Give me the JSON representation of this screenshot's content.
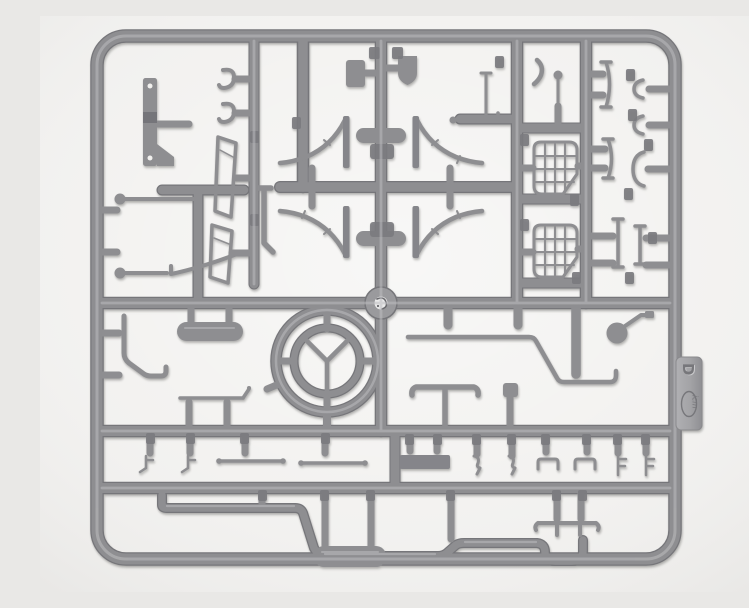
{
  "image": {
    "subject": "gray injection-molded plastic model kit sprue (parts runner) photographed on a light neutral background",
    "sprue_letter": "D",
    "brand": "ICM"
  },
  "colors": {
    "background": "#f1f0ee",
    "plastic": "#8e8e91",
    "plastic_dark": "#76767a",
    "plastic_light": "#bdbdc0",
    "gate_pad": "#7b7b7f",
    "tab_fill": "#a3a3a6",
    "emboss_dark": "#77777b",
    "emboss_light": "#c9c9cb"
  },
  "tab": {
    "letter": "D",
    "logo_text": "icm"
  },
  "parts_inventory": [
    "outer-frame",
    "letter-tab",
    "chassis-strap-with-holes",
    "tow-hooks",
    "windshield-frame-halves",
    "hand-levers-with-ball-knobs",
    "lever-quadrant-bracket",
    "seat-paddles",
    "leaf-spring-bundles",
    "fender-stays",
    "frame-blades",
    "pedal-linkage-rods",
    "curved-lever",
    "shift-lever-with-ball-knob",
    "grille-grid-panels",
    "spring-leaf-blades",
    "mounting-clips",
    "steering-wheel",
    "center-hub-boss",
    "bent-handbrake-rod",
    "tank-cylinder",
    "priming-rod",
    "tie-rods",
    "front-axle-tee",
    "floor-plate",
    "small-hook-brackets",
    "ball-with-crank-arm",
    "steering-drag-link",
    "driveshaft-rod",
    "exhaust-pipe-with-muffler",
    "fork-bracket"
  ]
}
